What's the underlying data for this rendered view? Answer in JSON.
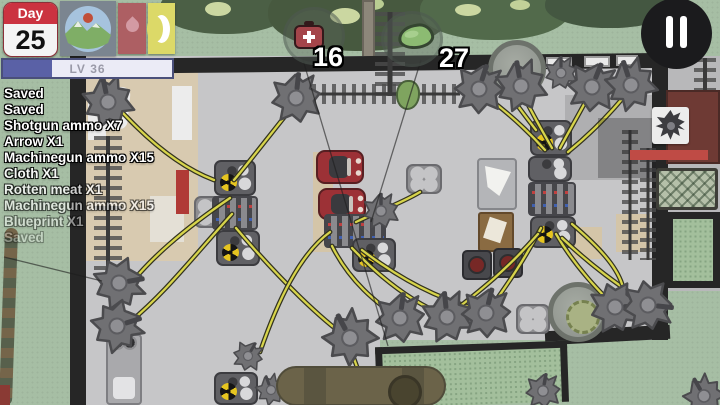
{
  "theme": {
    "grass": "#a6bea4",
    "floor": "#c6c6c8",
    "wall": "#262626",
    "wire": "#d7d44b",
    "wire_outline": "#32321f",
    "accent_red": "#bf4b45",
    "car_red": "#9c3136",
    "radiation_yellow": "#e6c520",
    "hud_level_fill": "#5a61a6",
    "day_header_red": "#cb3340",
    "moon_tile_yellow": "#dcd968",
    "blood_tile_red": "#ad5f63"
  },
  "hud": {
    "day": {
      "label": "Day",
      "value": "25"
    },
    "level": {
      "label": "LV 36",
      "progress_percent": 29
    },
    "status_icons": [
      {
        "name": "landscape-icon"
      },
      {
        "name": "blood-drop-icon"
      },
      {
        "name": "moon-icon"
      }
    ]
  },
  "log": {
    "entries": [
      "Saved",
      "Saved",
      "Shotgun ammo X7",
      "Arrow X1",
      "Machinegun ammo X15",
      "Cloth X1",
      "Rotten meat X1",
      "Machinegun ammo X15",
      "Blueprint X1",
      "Saved"
    ]
  },
  "map_counters": [
    {
      "icon": "medkit-icon",
      "value": "16"
    },
    {
      "icon": "herb-icon",
      "value": "27"
    }
  ],
  "enemy_panel": {
    "icon": "zombie-icon",
    "health_percent": 100
  }
}
